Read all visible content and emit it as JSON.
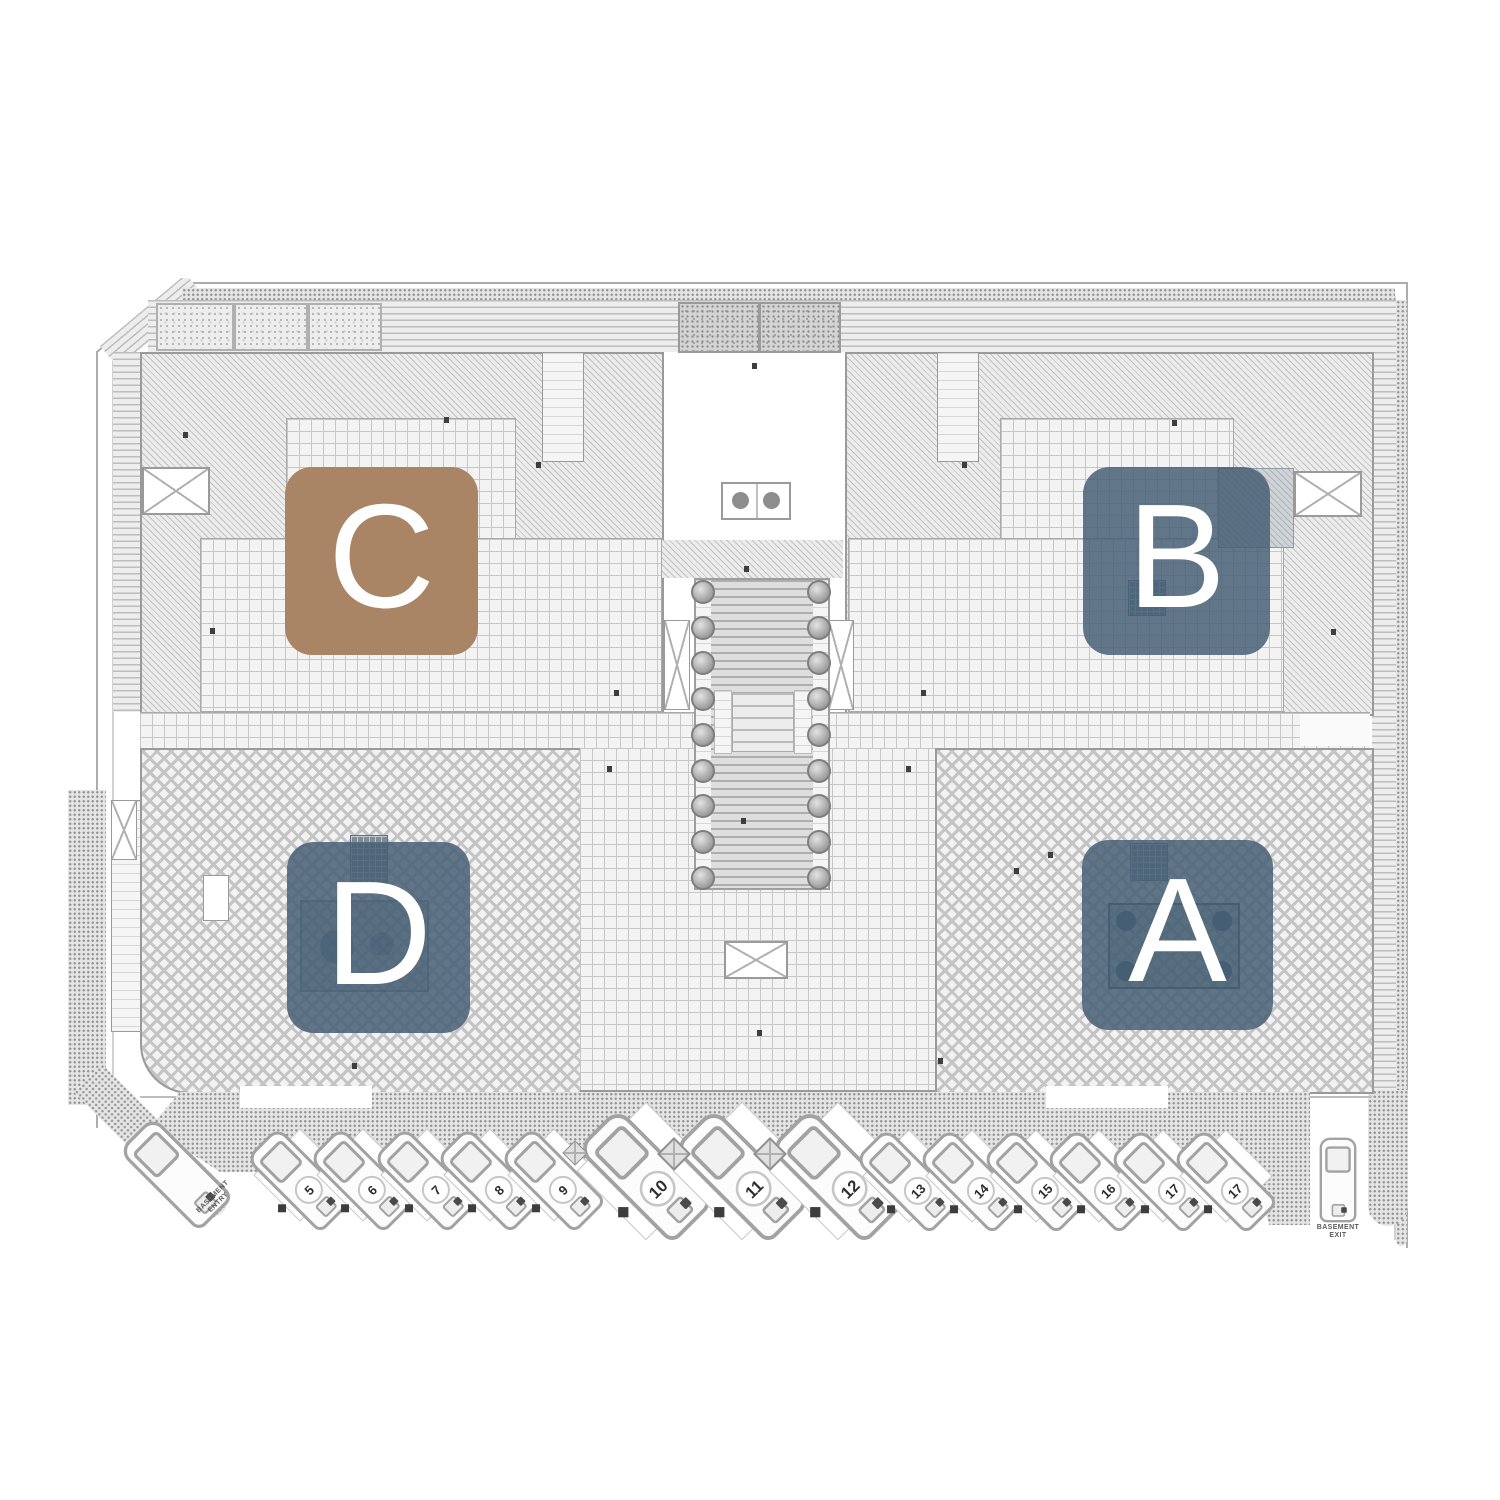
{
  "blocks": [
    {
      "id": "c",
      "label": "C",
      "color": "#a98566"
    },
    {
      "id": "b",
      "label": "B",
      "color": "rgba(70,95,116,0.85)"
    },
    {
      "id": "d",
      "label": "D",
      "color": "rgba(70,95,116,0.85)"
    },
    {
      "id": "a",
      "label": "A",
      "color": "rgba(70,95,116,0.85)"
    }
  ],
  "parking": {
    "spaces": [
      {
        "number": "5"
      },
      {
        "number": "6"
      },
      {
        "number": "7"
      },
      {
        "number": "8"
      },
      {
        "number": "9"
      },
      {
        "number": "10"
      },
      {
        "number": "11"
      },
      {
        "number": "12"
      },
      {
        "number": "13"
      },
      {
        "number": "14"
      },
      {
        "number": "15"
      },
      {
        "number": "16"
      },
      {
        "number": "17"
      },
      {
        "number": "17"
      }
    ],
    "basement_entry": {
      "line1": "BASEMENT",
      "line2": "ENTRY"
    },
    "basement_exit": {
      "line1": "BASEMENT",
      "line2": "EXIT"
    }
  }
}
